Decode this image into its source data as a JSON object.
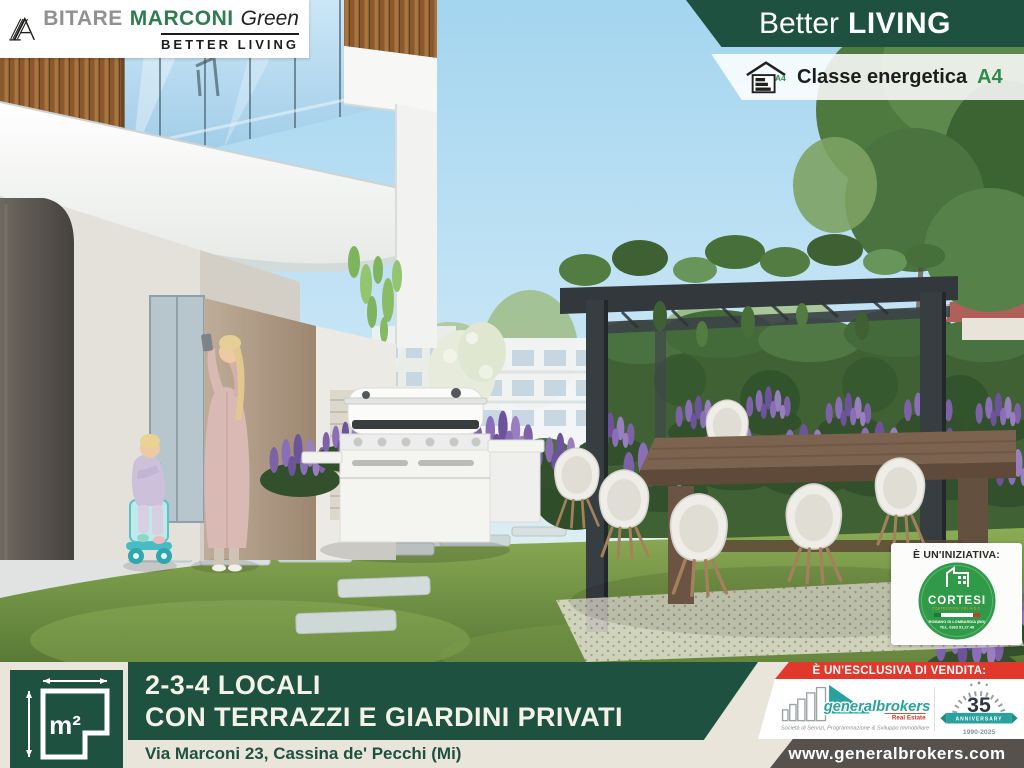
{
  "colors": {
    "green_dark": "#1e5140",
    "green_logo": "#2e7d4e",
    "gray_logo": "#8f9193",
    "beige": "#e9e5db",
    "red": "#e2382c",
    "teal": "#2aa29b",
    "cortesi_green": "#2f9a47",
    "www_bar": "#56514d",
    "energy_green": "#2e8b4f",
    "sky": "#aed9f0",
    "grass": "#6f9144"
  },
  "brand": {
    "a_glyph": "A",
    "part1": "BITARE",
    "part2": "MARCONI",
    "part3": "Green",
    "subtitle": "BETTER LIVING"
  },
  "header": {
    "banner_light": "Better",
    "banner_bold": "LIVING",
    "energy_label": "Classe energetica",
    "energy_class": "A4",
    "energy_icon_tag": "A4"
  },
  "initiative": {
    "heading": "È UN'INIZIATIVA:",
    "company": "CORTESI",
    "company_sub": "COSTRUZIONI SRL A S.C.",
    "city": "ROMANO DI LOMBARDIA (BG)",
    "phone": "TEL. 0363 91.27.49"
  },
  "footer": {
    "m2_label": "m²",
    "title_line1": "2-3-4 LOCALI",
    "title_line2": "CON TERRAZZI E GIARDINI PRIVATI",
    "address": "Via Marconi 23, Cassina de' Pecchi (Mi)",
    "exclusive_heading": "È UN'ESCLUSIVA DI VENDITA:",
    "agency": {
      "name": "generalbrokers",
      "sub": "Real Estate",
      "tagline": "Società di Servizi, Programmazione & Sviluppo Immobiliare",
      "anniversary_number": "35",
      "anniversary_label": "ANNIVERSARY",
      "anniversary_years": "1990-2025",
      "website": "www.generalbrokers.com"
    }
  }
}
